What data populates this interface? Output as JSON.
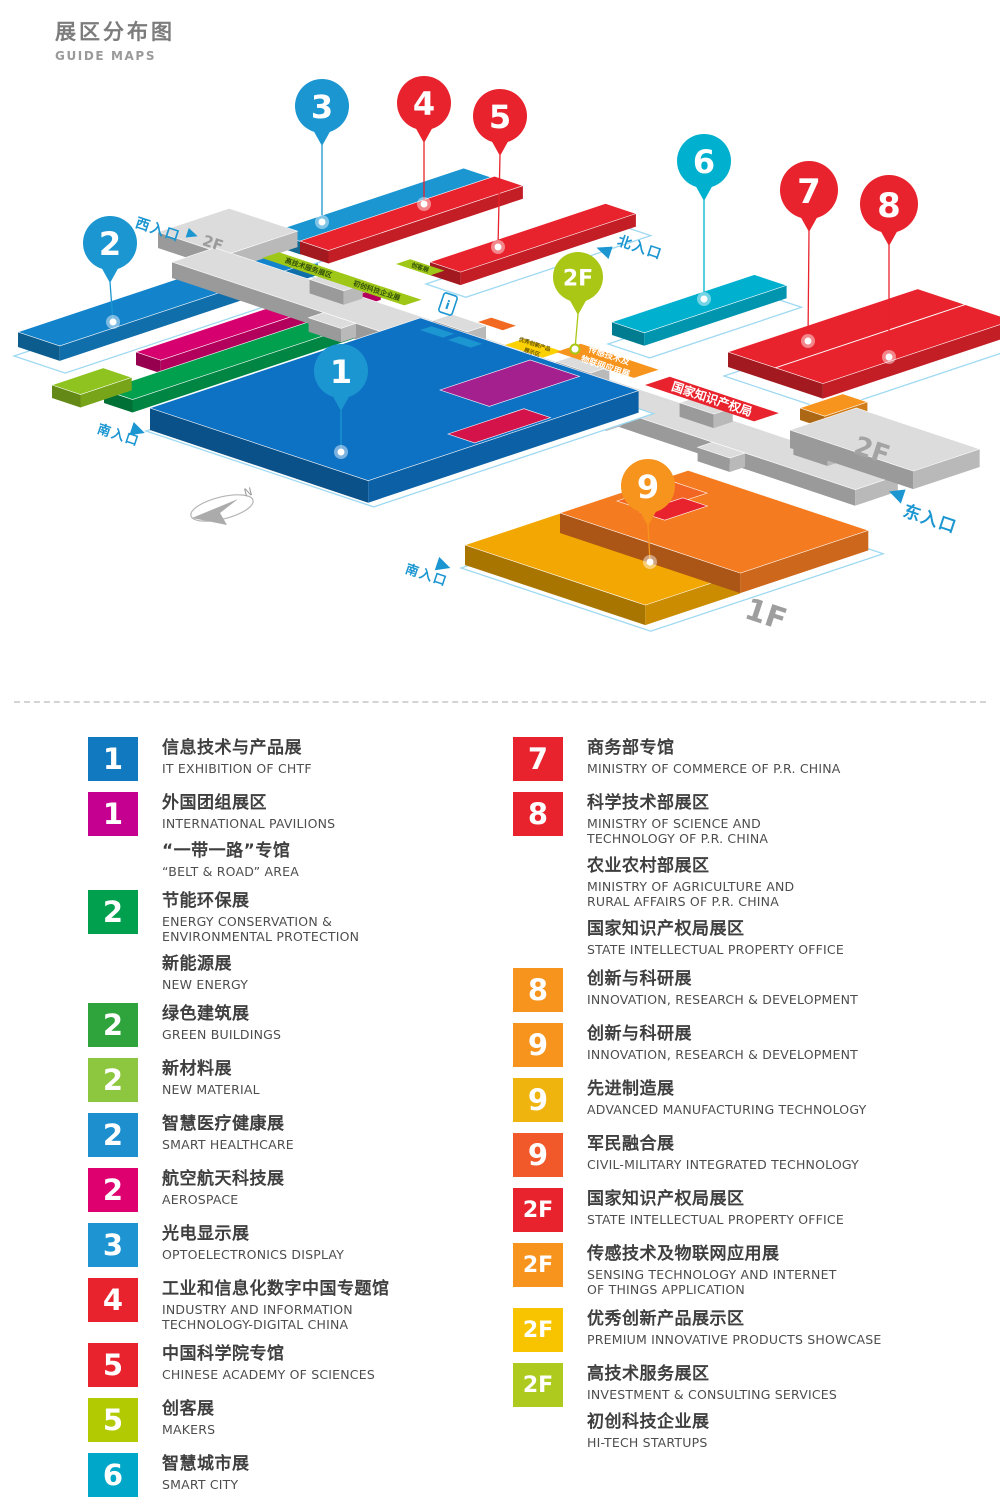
{
  "title": {
    "zh": "展区分布图",
    "en": "GUIDE MAPS"
  },
  "map": {
    "floor_labels": [
      {
        "name": "floor-label-2f-west",
        "text": "2F",
        "x": 213,
        "y": 243,
        "fs": 15,
        "color": "#9b9b9b"
      },
      {
        "name": "floor-label-2f-east",
        "text": "2F",
        "x": 872,
        "y": 450,
        "fs": 26,
        "color": "#a3a3a3"
      },
      {
        "name": "floor-label-1f",
        "text": "1F",
        "x": 766,
        "y": 614,
        "fs": 30,
        "color": "#9e9e9e"
      }
    ],
    "entrances": [
      {
        "name": "entrance-west",
        "text": "西入口",
        "x": 136,
        "y": 222,
        "tri": "52,-11 52,-1 63,-6",
        "fs": 14
      },
      {
        "name": "entrance-north",
        "text": "北入口",
        "x": 618,
        "y": 240,
        "tri": "-18,14 -3,8 -3,21",
        "fs": 14
      },
      {
        "name": "entrance-east",
        "text": "东入口",
        "x": 904,
        "y": 510,
        "tri": "-20,-13 -5,-20 -5,-5",
        "fs": 17
      },
      {
        "name": "entrance-south-west",
        "text": "南入口",
        "x": 98,
        "y": 428,
        "tri": "32,-17 46,-10 32,-3",
        "fs": 13
      },
      {
        "name": "entrance-south-bottom",
        "text": "南入口",
        "x": 406,
        "y": 568,
        "tri": "28,-21 42,-14 28,-7",
        "fs": 13
      }
    ],
    "halls_back": [
      {
        "name": "hall-2-blue",
        "x": 18,
        "y": 332,
        "lu": 272,
        "lv": 44,
        "h": 15,
        "color": "#1383cb",
        "plate": true
      },
      {
        "name": "hall-2-magenta",
        "x": 136,
        "y": 352,
        "lu": 232,
        "lv": 26,
        "h": 13,
        "color": "#d6006f"
      },
      {
        "name": "hall-2-green",
        "x": 104,
        "y": 390,
        "lu": 268,
        "lv": 30,
        "h": 13,
        "color": "#00a04e"
      },
      {
        "name": "hall-2-lime",
        "x": 52,
        "y": 385,
        "lu": 54,
        "lv": 30,
        "h": 13,
        "color": "#8fc31f"
      },
      {
        "name": "hall-3",
        "x": 272,
        "y": 232,
        "lu": 202,
        "lv": 30,
        "h": 13,
        "color": "#1b96d1",
        "plate": true
      },
      {
        "name": "hall-4",
        "x": 300,
        "y": 241,
        "lu": 205,
        "lv": 30,
        "h": 13,
        "color": "#e8232d"
      },
      {
        "name": "hall-5",
        "x": 430,
        "y": 262,
        "lu": 185,
        "lv": 32,
        "h": 13,
        "color": "#e8232d",
        "plate": true
      },
      {
        "name": "hall-6",
        "x": 612,
        "y": 322,
        "lu": 150,
        "lv": 34,
        "h": 13,
        "color": "#00b1cf",
        "plate": true
      },
      {
        "name": "hall-7-8",
        "x": 728,
        "y": 352,
        "lu": 200,
        "lv": 100,
        "h": 15,
        "color": "#e8232d",
        "plate": true,
        "divider": 50
      },
      {
        "name": "hall-8-orange-block",
        "x": 800,
        "y": 408,
        "lu": 45,
        "lv": 26,
        "h": 12,
        "color": "#f7941e"
      }
    ],
    "corridor": {
      "west": {
        "name": "corridor-west-platform",
        "x": 158,
        "y": 232,
        "lu": 75,
        "lv": 72,
        "h": 16
      },
      "spine": {
        "name": "corridor-spine",
        "x": 172,
        "y": 262,
        "lu": 45,
        "lv": 720,
        "h": 16
      },
      "east": {
        "name": "corridor-east-platform",
        "x": 790,
        "y": 430,
        "lu": 70,
        "lv": 130,
        "h": 18
      },
      "stubs_upper": [
        100,
        230,
        360,
        490,
        610
      ],
      "stubs_lower": [
        160,
        300,
        440,
        570
      ]
    },
    "halls_front": [
      {
        "name": "hall-1-plate",
        "x": 150,
        "y": 408,
        "lu": 285,
        "lv": 230,
        "plateOnly": true
      },
      {
        "name": "hall-1",
        "x": 150,
        "y": 408,
        "lu": 285,
        "lv": 230,
        "h": 22,
        "color": "#0e72c4"
      },
      {
        "name": "hall-1-purple",
        "x": 440,
        "y": 390,
        "lu": 95,
        "lv": 52,
        "h": 0,
        "color": "#a4208f"
      },
      {
        "name": "hall-1-crimson",
        "x": 448,
        "y": 434,
        "lu": 80,
        "lv": 28,
        "h": 0,
        "color": "#d31349"
      },
      {
        "name": "hall-9-plate",
        "x": 465,
        "y": 545,
        "lu": 235,
        "lv": 190,
        "plateOnly": true
      },
      {
        "name": "hall-9-amber",
        "x": 465,
        "y": 545,
        "lu": 100,
        "lv": 190,
        "h": 20,
        "color": "#f2a702"
      },
      {
        "name": "hall-9-orange",
        "x": 560,
        "y": 513,
        "lu": 135,
        "lv": 190,
        "h": 20,
        "color": "#f47b20"
      },
      {
        "name": "hall-9-dark-orange",
        "x": 617,
        "y": 501,
        "lu": 60,
        "lv": 35,
        "h": 0,
        "color": "#f26522"
      },
      {
        "name": "hall-9-red",
        "x": 640,
        "y": 512,
        "lu": 45,
        "lv": 26,
        "h": 0,
        "color": "#e8232d"
      }
    ],
    "tags": [
      {
        "name": "tag-hi-tech-services",
        "x": 262,
        "y": 258,
        "lu": 18,
        "lv": 150,
        "color": "#9fc718",
        "texts": [
          {
            "t": 40,
            "text": "高技术服务展区"
          },
          {
            "t": 112,
            "text": "初创科技企业展"
          }
        ],
        "fs": 7,
        "tc": "#33520a"
      },
      {
        "name": "tag-makers",
        "x": 396,
        "y": 264,
        "lu": 15,
        "lv": 36,
        "color": "#9fc718",
        "texts": [
          {
            "t": 18,
            "text": "创客展"
          }
        ],
        "fs": 6,
        "tc": "#33520a"
      },
      {
        "name": "tag-service-blue-1",
        "x": 420,
        "y": 330,
        "lu": 12,
        "lv": 24,
        "color": "#1b96d1",
        "texts": []
      },
      {
        "name": "tag-service-blue-2",
        "x": 448,
        "y": 340,
        "lu": 12,
        "lv": 24,
        "color": "#1b96d1",
        "texts": []
      },
      {
        "name": "tag-restaurant",
        "x": 478,
        "y": 322,
        "lu": 14,
        "lv": 26,
        "color": "#f26a21",
        "texts": []
      },
      {
        "name": "tag-premium-products",
        "x": 505,
        "y": 345,
        "lu": 20,
        "lv": 40,
        "color": "#fdd000",
        "lines": [
          "优秀创新产品",
          "展示区"
        ],
        "fs": 5.5,
        "tc": "#6b5800"
      },
      {
        "name": "tag-sensing-iot",
        "x": 556,
        "y": 352,
        "lu": 26,
        "lv": 82,
        "color": "#f7941e",
        "lines": [
          "传感技术及",
          "物联网应用展"
        ],
        "fs": 8.5,
        "tc": "#ffffff"
      },
      {
        "name": "tag-intellectual-property",
        "x": 645,
        "y": 385,
        "lu": 26,
        "lv": 115,
        "color": "#e8232d",
        "lines": [
          "国家知识产权局"
        ],
        "fs": 12,
        "tc": "#ffffff"
      }
    ],
    "info_icon": {
      "name": "info-icon",
      "x": 448,
      "y": 304,
      "label": "i"
    },
    "pins": [
      {
        "name": "pin-2",
        "label": "2",
        "cx": 110,
        "cy": 243,
        "r": 27,
        "fs": 32,
        "color": "#1b96d1",
        "dx": 113,
        "dy": 322
      },
      {
        "name": "pin-3",
        "label": "3",
        "cx": 322,
        "cy": 106,
        "r": 27,
        "fs": 32,
        "color": "#1b96d1",
        "dx": 322,
        "dy": 222
      },
      {
        "name": "pin-4",
        "label": "4",
        "cx": 424,
        "cy": 103,
        "r": 27,
        "fs": 32,
        "color": "#e8232d",
        "dx": 424,
        "dy": 204
      },
      {
        "name": "pin-5",
        "label": "5",
        "cx": 500,
        "cy": 116,
        "r": 27,
        "fs": 32,
        "color": "#e8232d",
        "dx": 498,
        "dy": 247
      },
      {
        "name": "pin-2f",
        "label": "2F",
        "cx": 578,
        "cy": 277,
        "r": 25,
        "fs": 22,
        "color": "#a9c714",
        "dx": 575,
        "dy": 349,
        "ring": true
      },
      {
        "name": "pin-6",
        "label": "6",
        "cx": 704,
        "cy": 161,
        "r": 27,
        "fs": 32,
        "color": "#00b1cf",
        "dx": 704,
        "dy": 299
      },
      {
        "name": "pin-7",
        "label": "7",
        "cx": 809,
        "cy": 190,
        "r": 29,
        "fs": 34,
        "color": "#e8232d",
        "dx": 808,
        "dy": 341
      },
      {
        "name": "pin-8",
        "label": "8",
        "cx": 889,
        "cy": 204,
        "r": 29,
        "fs": 34,
        "color": "#e8232d",
        "dx": 889,
        "dy": 357
      },
      {
        "name": "pin-1",
        "label": "1",
        "cx": 341,
        "cy": 371,
        "r": 27,
        "fs": 32,
        "color": "#1b96d1",
        "dx": 341,
        "dy": 452
      },
      {
        "name": "pin-9",
        "label": "9",
        "cx": 648,
        "cy": 486,
        "r": 27,
        "fs": 32,
        "color": "#f7941e",
        "dx": 650,
        "dy": 562
      }
    ],
    "compass": {
      "name": "compass",
      "x": 222,
      "y": 508,
      "label": "N"
    }
  },
  "legend": {
    "left": [
      {
        "badge": "1",
        "color": "#1079bf",
        "entries": [
          {
            "zh": "信息技术与产品展",
            "en": "IT EXHIBITION OF CHTF"
          }
        ]
      },
      {
        "badge": "1",
        "color": "#c50090",
        "entries": [
          {
            "zh": "外国团组展区",
            "en": "INTERNATIONAL PAVILIONS"
          },
          {
            "zh": "“一带一路”专馆",
            "en": "“BELT & ROAD” AREA"
          }
        ]
      },
      {
        "badge": "2",
        "color": "#00a04e",
        "entries": [
          {
            "zh": "节能环保展",
            "en": "ENERGY CONSERVATION &\nENVIRONMENTAL PROTECTION"
          },
          {
            "zh": "新能源展",
            "en": "NEW ENERGY"
          }
        ]
      },
      {
        "badge": "2",
        "color": "#2fa43c",
        "entries": [
          {
            "zh": "绿色建筑展",
            "en": "GREEN BUILDINGS"
          }
        ]
      },
      {
        "badge": "2",
        "color": "#8dc63f",
        "entries": [
          {
            "zh": "新材料展",
            "en": "NEW MATERIAL"
          }
        ]
      },
      {
        "badge": "2",
        "color": "#1e8fce",
        "entries": [
          {
            "zh": "智慧医疗健康展",
            "en": "SMART HEALTHCARE"
          }
        ]
      },
      {
        "badge": "2",
        "color": "#df0070",
        "entries": [
          {
            "zh": "航空航天科技展",
            "en": "AEROSPACE"
          }
        ]
      },
      {
        "badge": "3",
        "color": "#1e95d2",
        "entries": [
          {
            "zh": "光电显示展",
            "en": "OPTOELECTRONICS DISPLAY"
          }
        ]
      },
      {
        "badge": "4",
        "color": "#e8232d",
        "entries": [
          {
            "zh": "工业和信息化数字中国专题馆",
            "en": "INDUSTRY AND INFORMATION\nTECHNOLOGY-DIGITAL CHINA"
          }
        ]
      },
      {
        "badge": "5",
        "color": "#e8232d",
        "entries": [
          {
            "zh": "中国科学院专馆",
            "en": "CHINESE ACADEMY OF SCIENCES"
          }
        ]
      },
      {
        "badge": "5",
        "color": "#b2ca02",
        "entries": [
          {
            "zh": "创客展",
            "en": "MAKERS"
          }
        ]
      },
      {
        "badge": "6",
        "color": "#00a7c8",
        "entries": [
          {
            "zh": "智慧城市展",
            "en": "SMART CITY"
          }
        ]
      }
    ],
    "right": [
      {
        "badge": "7",
        "color": "#e8232d",
        "entries": [
          {
            "zh": "商务部专馆",
            "en": "MINISTRY OF COMMERCE OF P.R. CHINA"
          }
        ]
      },
      {
        "badge": "8",
        "color": "#e8232d",
        "entries": [
          {
            "zh": "科学技术部展区",
            "en": "MINISTRY OF SCIENCE AND\nTECHNOLOGY OF P.R. CHINA"
          },
          {
            "zh": "农业农村部展区",
            "en": "MINISTRY OF AGRICULTURE AND\nRURAL AFFAIRS OF P.R. CHINA"
          },
          {
            "zh": "国家知识产权局展区",
            "en": "STATE INTELLECTUAL PROPERTY OFFICE"
          }
        ]
      },
      {
        "badge": "8",
        "color": "#f7941d",
        "entries": [
          {
            "zh": "创新与科研展",
            "en": "INNOVATION, RESEARCH & DEVELOPMENT"
          }
        ]
      },
      {
        "badge": "9",
        "color": "#f7941d",
        "entries": [
          {
            "zh": "创新与科研展",
            "en": "INNOVATION, RESEARCH & DEVELOPMENT"
          }
        ]
      },
      {
        "badge": "9",
        "color": "#f0b40f",
        "entries": [
          {
            "zh": "先进制造展",
            "en": "ADVANCED MANUFACTURING TECHNOLOGY"
          }
        ]
      },
      {
        "badge": "9",
        "color": "#f1592a",
        "entries": [
          {
            "zh": "军民融合展",
            "en": "CIVIL-MILITARY INTEGRATED TECHNOLOGY"
          }
        ]
      },
      {
        "badge": "2F",
        "color": "#e8232d",
        "entries": [
          {
            "zh": "国家知识产权局展区",
            "en": "STATE INTELLECTUAL PROPERTY OFFICE"
          }
        ]
      },
      {
        "badge": "2F",
        "color": "#f7941d",
        "entries": [
          {
            "zh": "传感技术及物联网应用展",
            "en": "SENSING TECHNOLOGY AND INTERNET\nOF THINGS APPLICATION"
          }
        ]
      },
      {
        "badge": "2F",
        "color": "#f8c400",
        "entries": [
          {
            "zh": "优秀创新产品展示区",
            "en": "PREMIUM INNOVATIVE PRODUCTS SHOWCASE"
          }
        ]
      },
      {
        "badge": "2F",
        "color": "#afca1e",
        "entries": [
          {
            "zh": "高技术服务展区",
            "en": "INVESTMENT & CONSULTING SERVICES"
          },
          {
            "zh": "初创科技企业展",
            "en": "HI-TECH STARTUPS"
          }
        ]
      }
    ]
  }
}
